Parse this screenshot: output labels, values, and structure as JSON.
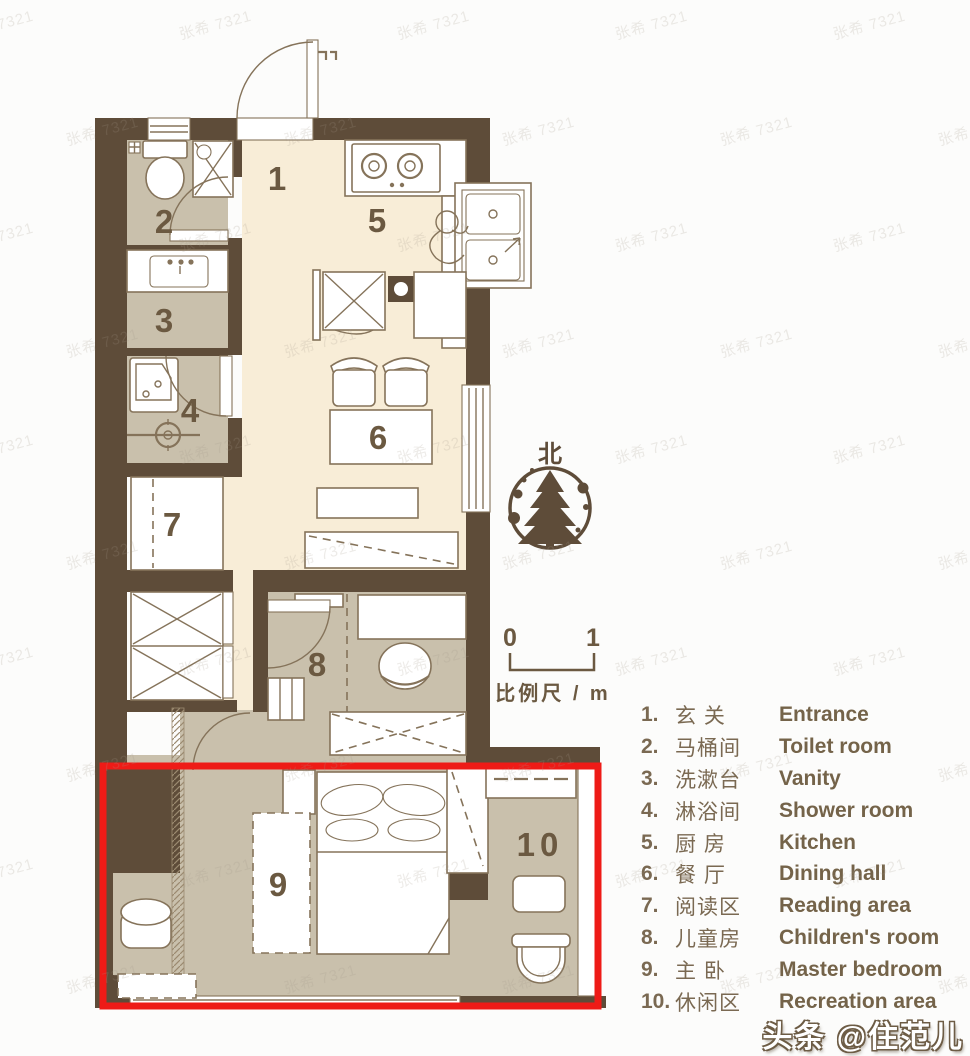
{
  "colors": {
    "wall": "#5e4c39",
    "cream_floor": "#f8edd7",
    "tan_floor": "#c9c0ac",
    "outline": "#85735a",
    "highlight_red": "#ee1b17",
    "legend_text": "#7a6952"
  },
  "plan": {
    "room_labels": [
      "1",
      "2",
      "3",
      "4",
      "5",
      "6",
      "7",
      "8",
      "9",
      "10"
    ]
  },
  "north": {
    "label": "北"
  },
  "scale_bar": {
    "start": "0",
    "end": "1",
    "caption": "比例尺 / m"
  },
  "legend": {
    "items": [
      {
        "num": "1.",
        "zh": "玄 关",
        "en": "Entrance"
      },
      {
        "num": "2.",
        "zh": "马桶间",
        "en": "Toilet room"
      },
      {
        "num": "3.",
        "zh": "洗漱台",
        "en": "Vanity"
      },
      {
        "num": "4.",
        "zh": "淋浴间",
        "en": "Shower room"
      },
      {
        "num": "5.",
        "zh": "厨 房",
        "en": "Kitchen"
      },
      {
        "num": "6.",
        "zh": "餐 厅",
        "en": "Dining hall"
      },
      {
        "num": "7.",
        "zh": "阅读区",
        "en": "Reading area"
      },
      {
        "num": "8.",
        "zh": "儿童房",
        "en": "Children's room"
      },
      {
        "num": "9.",
        "zh": "主 卧",
        "en": "Master bedroom"
      },
      {
        "num": "10.",
        "zh": "休闲区",
        "en": "Recreation area"
      }
    ]
  },
  "watermarks": {
    "tile": "张希 7321",
    "credit": "头条 @住范儿"
  }
}
